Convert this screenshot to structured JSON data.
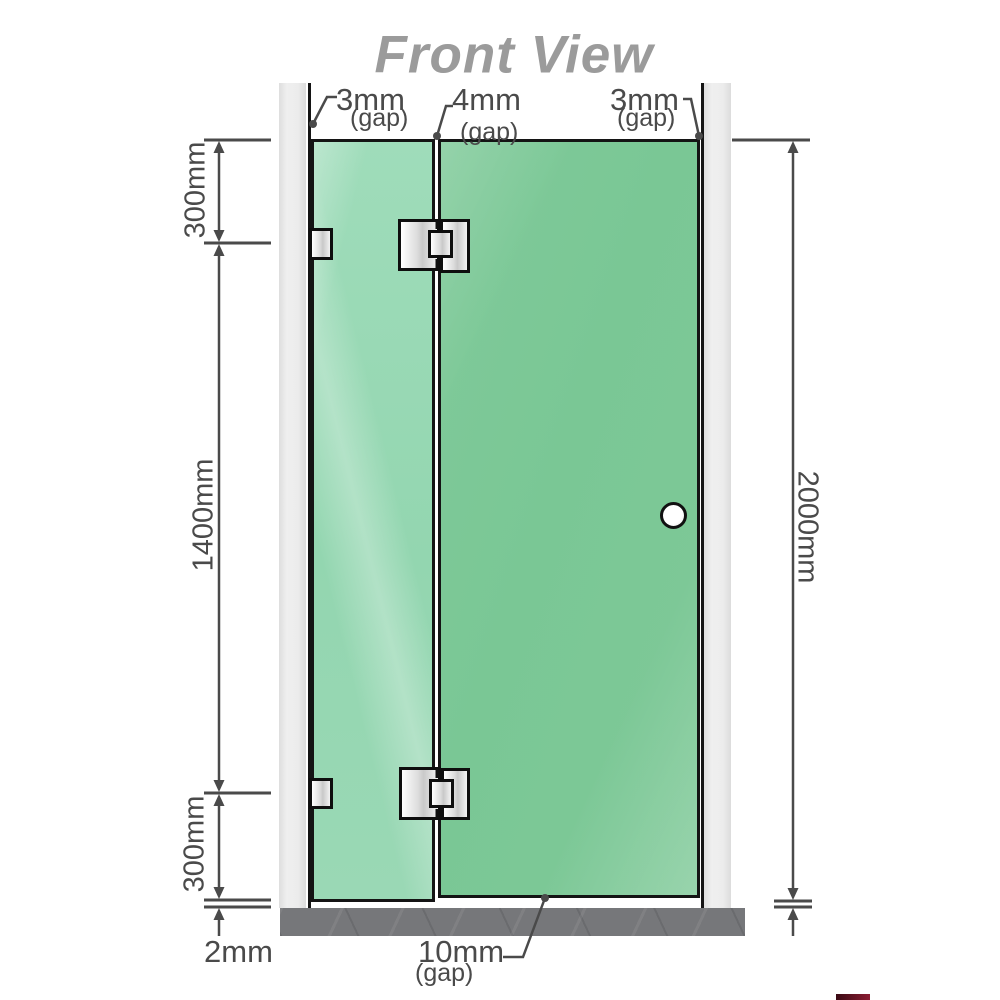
{
  "title": "Front View",
  "dimensions": {
    "gap_top_left": "3mm",
    "gap_top_left_sub": "(gap)",
    "gap_top_middle": "4mm",
    "gap_top_middle_sub": "(gap)",
    "gap_top_right": "3mm",
    "gap_top_right_sub": "(gap)",
    "left_top": "300mm",
    "left_middle": "1400mm",
    "left_bottom": "300mm",
    "bottom_left": "2mm",
    "right_total": "2000mm",
    "bottom_gap": "10mm",
    "bottom_gap_sub": "(gap)"
  },
  "colors": {
    "title": "#9b9b9b",
    "dimension": "#4a4a4a",
    "glass_fixed": "#9dd9b6",
    "glass_door": "#7cc795",
    "glass_outline": "#141414",
    "wall_post": "#eaeaea",
    "floor": "#76777a",
    "hardware": "#ededed",
    "knob": "#ffffff",
    "watermark": "#7e1b2f"
  }
}
